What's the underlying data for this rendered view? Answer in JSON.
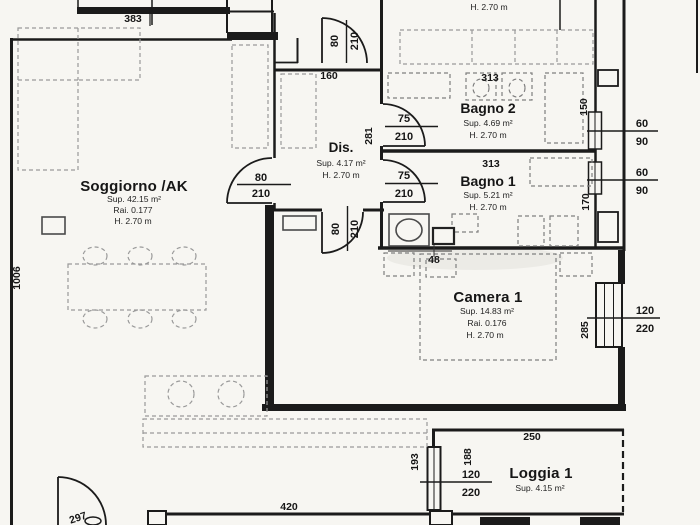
{
  "plan": {
    "rooms": {
      "top_partial": {
        "height": "H. 2.70 m"
      },
      "soggiorno": {
        "name": "Soggiorno /AK",
        "area": "Sup. 42.15 m²",
        "ratio": "Rai. 0.177",
        "height": "H. 2.70 m"
      },
      "dis": {
        "name": "Dis.",
        "area": "Sup. 4.17 m²",
        "height": "H. 2.70 m"
      },
      "bagno2": {
        "name": "Bagno 2",
        "area": "Sup. 4.69 m²",
        "height": "H. 2.70 m"
      },
      "bagno1": {
        "name": "Bagno 1",
        "area": "Sup. 5.21 m²",
        "height": "H. 2.70 m"
      },
      "camera1": {
        "name": "Camera 1",
        "area": "Sup. 14.83 m²",
        "ratio": "Rai. 0.176",
        "height": "H. 2.70 m"
      },
      "loggia1": {
        "name": "Loggia 1",
        "area": "Sup. 4.15 m²"
      }
    },
    "dims": {
      "top_width": "383",
      "left_height": "1006",
      "dis_width": "160",
      "dis_height": "281",
      "bagno2_width": "313",
      "bagno1_width": "313",
      "shaft_top": "150",
      "shaft_bottom": "170",
      "wall_stub": "48",
      "camera_window_offset": "285",
      "loggia_width": "250",
      "loggia_height": "188",
      "kitchen_offset": "193",
      "bottom_width": "420",
      "entry_width": "297"
    },
    "openings": {
      "entry_door": {
        "w": "80",
        "h": "210"
      },
      "soggiorno_door": {
        "w": "80",
        "h": "210"
      },
      "camera_door": {
        "w": "80",
        "h": "210"
      },
      "bagno2_door": {
        "w": "75",
        "h": "210"
      },
      "bagno1_door": {
        "w": "75",
        "h": "210"
      },
      "bagno2_window": {
        "w": "60",
        "h": "90"
      },
      "bagno1_window": {
        "w": "60",
        "h": "90"
      },
      "camera_window": {
        "w": "120",
        "h": "220"
      },
      "loggia_window": {
        "w": "120",
        "h": "220"
      }
    },
    "colors": {
      "ink": "#1b1b1b",
      "paper": "#f7f6f2",
      "furniture": "#9a9a9a"
    }
  }
}
